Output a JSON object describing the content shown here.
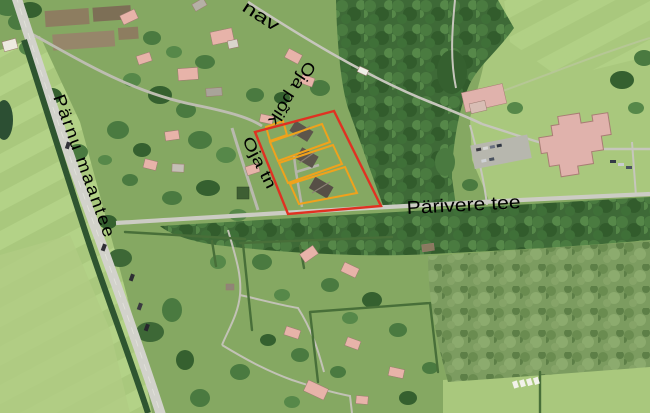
{
  "map": {
    "type": "aerial-orthophoto",
    "labels": {
      "parnu_maantee": "Pärnu maantee",
      "parivere_tee": "Pärivere tee",
      "oja_poik": "Oja põik",
      "oja_tn": "Oja tn",
      "street_partial": "nav"
    },
    "colors": {
      "label_text": "#000000",
      "selected_parcel_outline": "#e03122",
      "subparcel_outline": "#f0a21c",
      "road_fill": "#d2d2cb",
      "minor_road_fill": "#c2c2b6",
      "house_roof_pink": "#e7b3a9",
      "school_roof_pink": "#e0b2ac",
      "field_light_green": "#b7d18d",
      "meadow_green": "#a9c87d",
      "forest_green": "#3e6a37",
      "scrub_green": "#7c9c60"
    },
    "features": {
      "selected_parcel": {
        "outline_color_name": "red",
        "subparcel_count": 3,
        "building_count": 3,
        "small_subparcel_count": 1
      }
    }
  }
}
